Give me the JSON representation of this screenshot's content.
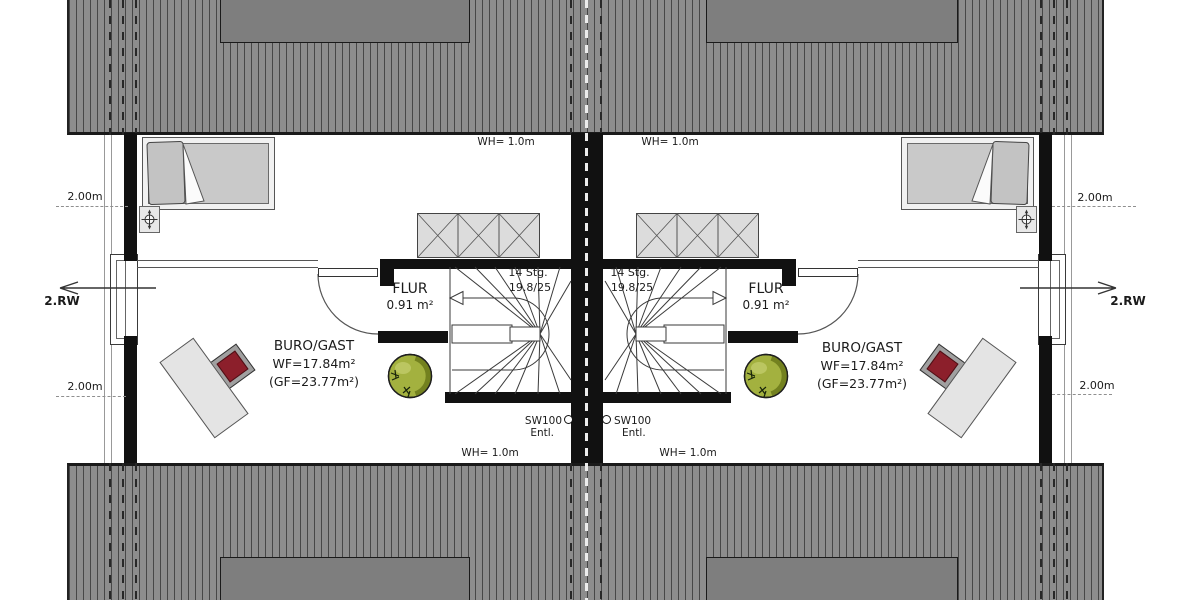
{
  "units": [
    {
      "side": "left",
      "room": {
        "name": "BURO/GAST",
        "living_area": "WF=17.84m²",
        "floor_area": "(GF=23.77m²)"
      },
      "hall": {
        "name": "FLUR",
        "area": "0.91 m²"
      },
      "stair": {
        "steps": "14 Stg.",
        "rise_run": "19.8/25"
      },
      "wall_height_top": "WH= 1.0m",
      "wall_height_bottom": "WH= 1.0m",
      "vent": {
        "code": "SW100",
        "type": "Entl."
      },
      "dim_upper": "2.00m",
      "dim_lower": "2.00m",
      "escape_route": "2.RW"
    },
    {
      "side": "right",
      "room": {
        "name": "BURO/GAST",
        "living_area": "WF=17.84m²",
        "floor_area": "(GF=23.77m²)"
      },
      "hall": {
        "name": "FLUR",
        "area": "0.91 m²"
      },
      "stair": {
        "steps": "14 Stg.",
        "rise_run": "19.8/25"
      },
      "wall_height_top": "WH= 1.0m",
      "wall_height_bottom": "WH= 1.0m",
      "vent": {
        "code": "SW100",
        "type": "Entl."
      },
      "dim_upper": "2.00m",
      "dim_lower": "2.00m",
      "escape_route": "2.RW"
    }
  ],
  "colors": {
    "roof": "#8d8d8d",
    "roof_hatch": "#474747",
    "dormer": "#7e7e7e",
    "wall": "#111111",
    "closet_fill": "#dcdcdc",
    "bed_fill": "#c9c9c9",
    "desk_fill": "#e4e4e4",
    "chair_seat": "#8c1f2b",
    "plant_light": "#a3b13f",
    "plant_dark": "#73811f"
  }
}
